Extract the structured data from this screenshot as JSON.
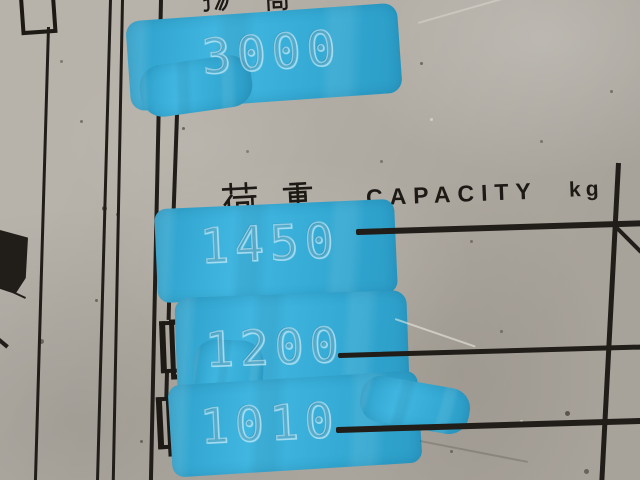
{
  "plate": {
    "lift_height_label": "揚 高",
    "lift_height_value": "3000",
    "capacity_label_jp": "荷 重",
    "capacity_label_en": "CAPACITY",
    "capacity_unit": "kg",
    "capacity_rows": [
      {
        "value": "1450"
      },
      {
        "value": "1200"
      },
      {
        "value": "1010"
      }
    ]
  },
  "colors": {
    "background": "#b2ada4",
    "ink": "#1d1a16",
    "paint_blue": "#36acd6",
    "stamp_outline": "#d0f0fb",
    "plate_silver": "#dddcd7",
    "worn_dark": "#55514b"
  }
}
